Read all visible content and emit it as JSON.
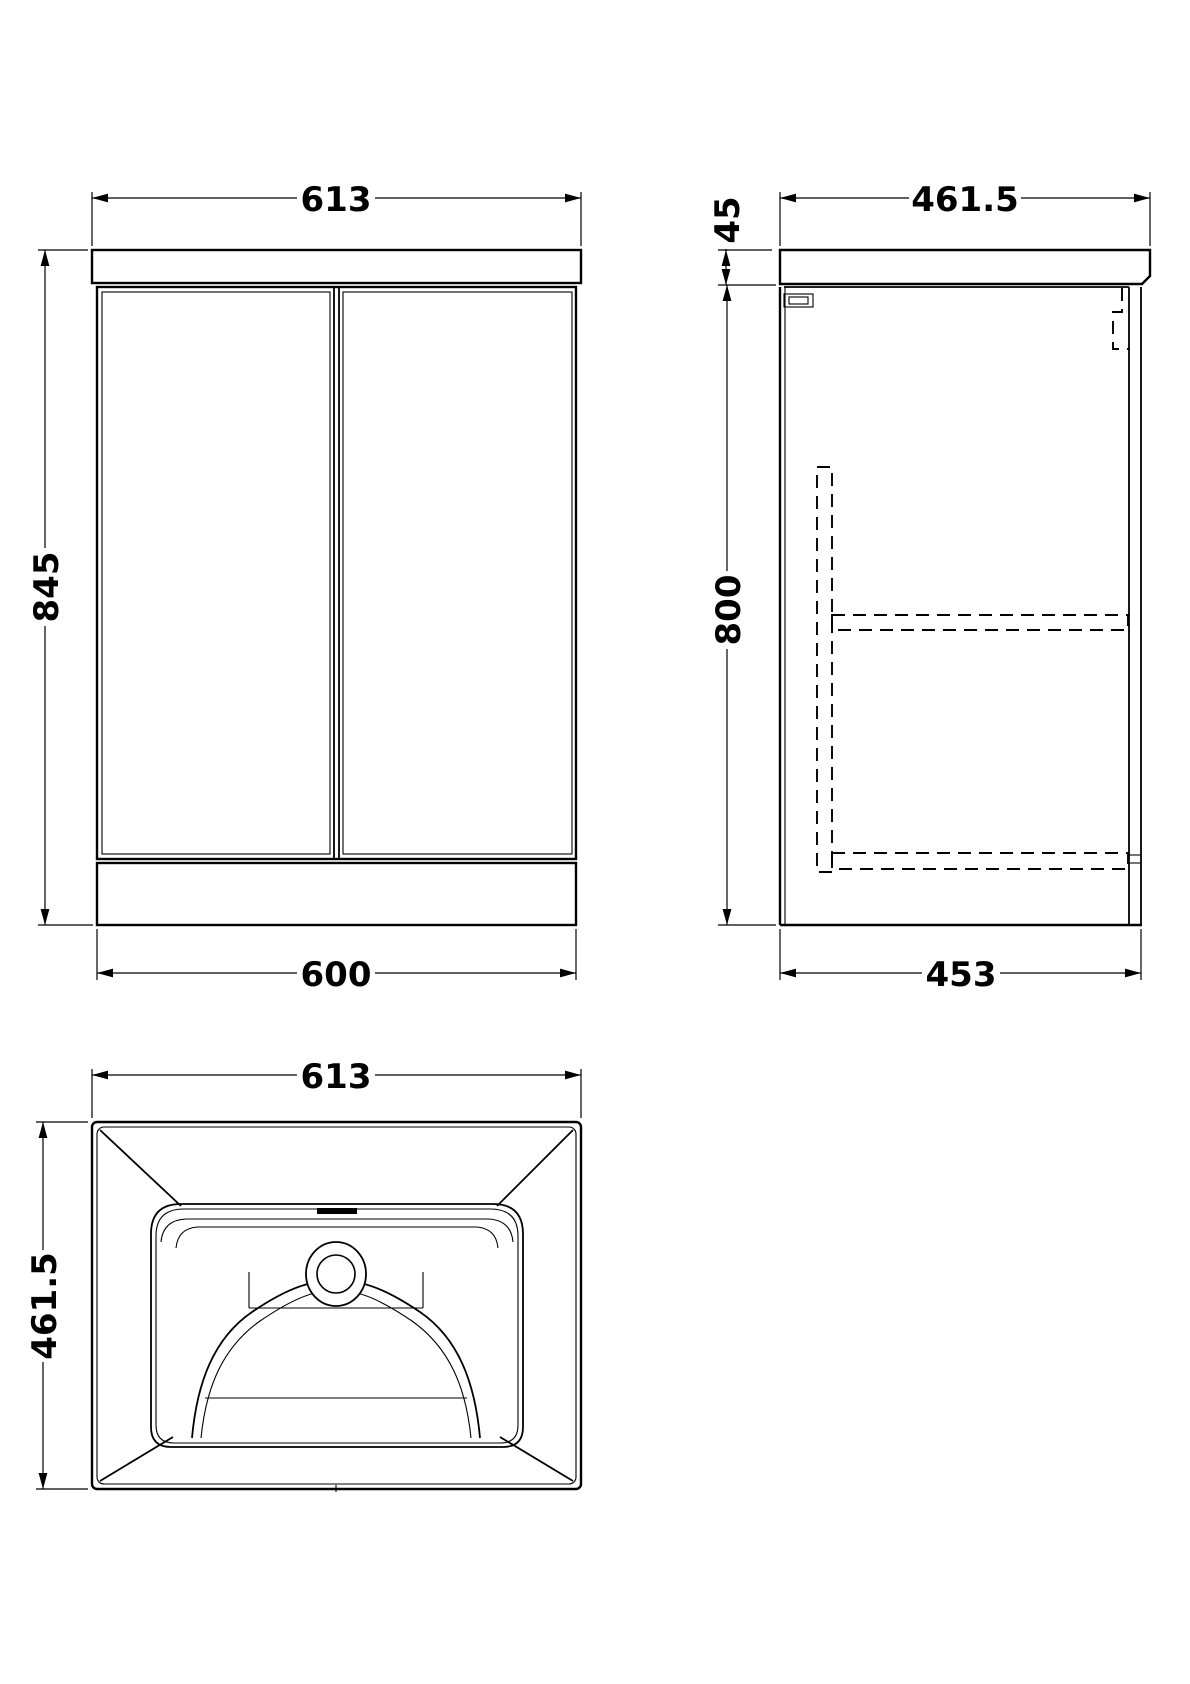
{
  "drawing": {
    "type": "technical-orthographic-drawing",
    "subject": "floor-standing vanity unit with basin",
    "line_color": "#000000",
    "background_color": "#ffffff",
    "views": {
      "front": {
        "name": "front-view",
        "dims": {
          "top_width": "613",
          "height": "845",
          "bottom_width": "600"
        }
      },
      "side": {
        "name": "side-view",
        "dims": {
          "top_depth": "461.5",
          "worktop_thickness": "45",
          "cabinet_height": "800",
          "bottom_depth": "453"
        }
      },
      "plan": {
        "name": "plan-view-basin",
        "dims": {
          "width": "613",
          "depth": "461.5"
        }
      }
    }
  }
}
